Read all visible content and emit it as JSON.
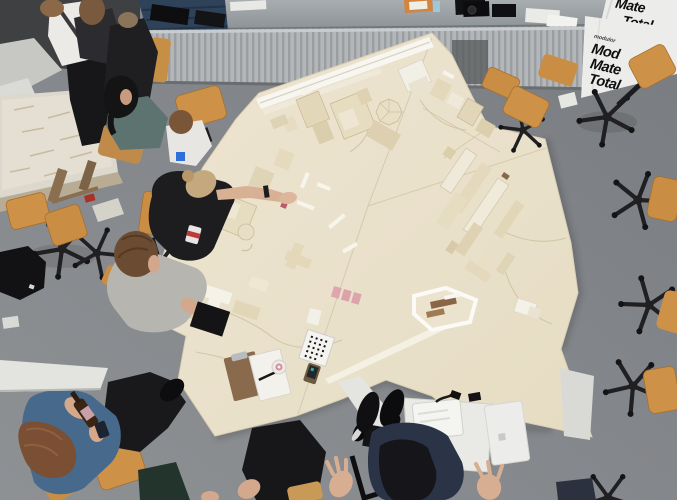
{
  "photo": {
    "subject": "overhead-view-architecture-studio-with-large-site-model"
  },
  "banner": {
    "corner_lines": [
      "Mate",
      "Total"
    ],
    "main_logo": "modulor",
    "main_lines": [
      "Mod",
      "Mate",
      "Total"
    ]
  },
  "palette": {
    "floor": "#85888b",
    "model_board": "#e9e0ca",
    "chair_wood": "#cd9247",
    "banner_white": "#ecedeb",
    "pink_notes": "#dda4ac"
  }
}
